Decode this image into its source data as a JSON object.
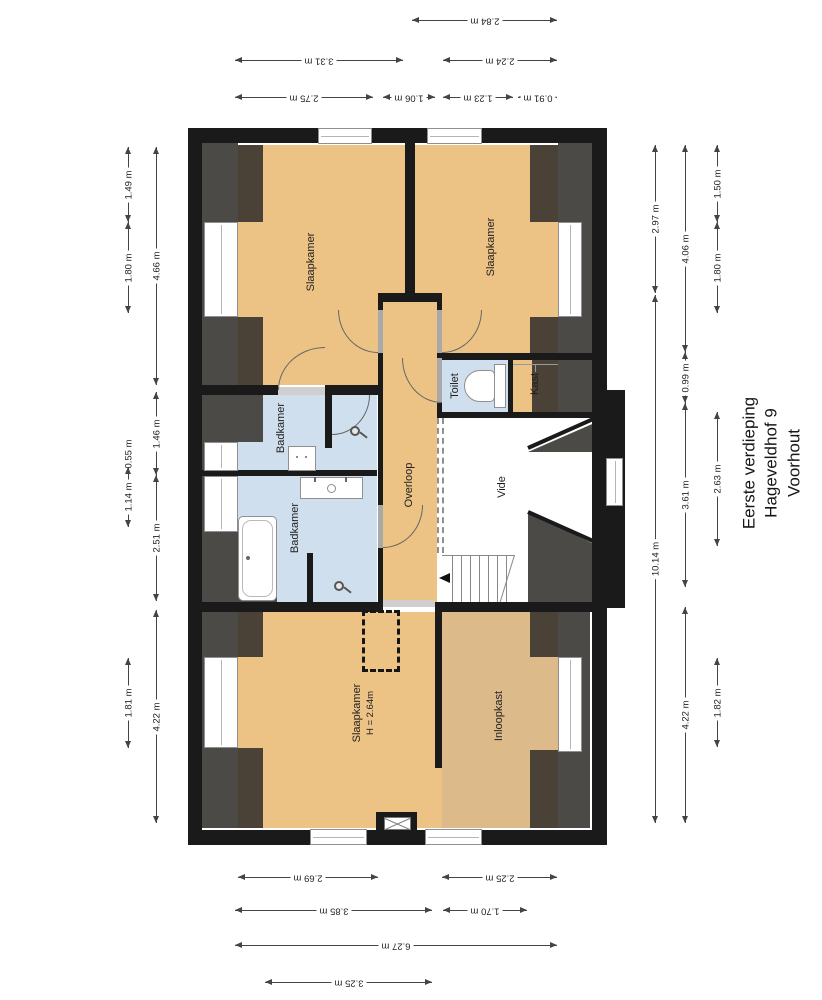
{
  "title": {
    "lines": [
      "Eerste verdieping",
      "Hageveldhof 9",
      "Voorhout"
    ]
  },
  "rooms": [
    {
      "name": "slaapkamer-top-left",
      "label": "Slaapkamer",
      "x": 312,
      "y": 262
    },
    {
      "name": "slaapkamer-top-right",
      "label": "Slaapkamer",
      "x": 492,
      "y": 247
    },
    {
      "name": "badkamer-small",
      "label": "Badkamer",
      "x": 282,
      "y": 428
    },
    {
      "name": "badkamer-large",
      "label": "Badkamer",
      "x": 296,
      "y": 528
    },
    {
      "name": "overloop",
      "label": "Overloop",
      "x": 410,
      "y": 485
    },
    {
      "name": "toilet",
      "label": "Toilet",
      "x": 456,
      "y": 386
    },
    {
      "name": "kast",
      "label": "Kast",
      "x": 536,
      "y": 384
    },
    {
      "name": "vide",
      "label": "Vide",
      "x": 503,
      "y": 487
    },
    {
      "name": "slaapkamer-bottom",
      "label": "Slaapkamer",
      "sub": "H = 2.64m",
      "x": 364,
      "y": 713
    },
    {
      "name": "inloopkast",
      "label": "Inloopkast",
      "x": 500,
      "y": 716
    }
  ],
  "dimensions": {
    "top": [
      {
        "label": "2.84 m",
        "from": 412,
        "to": 557,
        "at": 20
      },
      {
        "label": "3.31 m",
        "from": 235,
        "to": 403,
        "at": 60
      },
      {
        "label": "2.24 m",
        "from": 443,
        "to": 557,
        "at": 60
      },
      {
        "label": "2.75 m",
        "from": 235,
        "to": 373,
        "at": 97
      },
      {
        "label": "1.06 m",
        "from": 383,
        "to": 435,
        "at": 97
      },
      {
        "label": "1.23 m",
        "from": 443,
        "to": 513,
        "at": 97
      },
      {
        "label": "0.91 m",
        "from": 518,
        "to": 557,
        "at": 97
      }
    ],
    "bottom": [
      {
        "label": "2.69 m",
        "from": 238,
        "to": 378,
        "at": 877
      },
      {
        "label": "2.25 m",
        "from": 442,
        "to": 557,
        "at": 877
      },
      {
        "label": "3.85 m",
        "from": 235,
        "to": 432,
        "at": 910
      },
      {
        "label": "1.70 m",
        "from": 443,
        "to": 527,
        "at": 910
      },
      {
        "label": "6.27 m",
        "from": 235,
        "to": 557,
        "at": 945
      },
      {
        "label": "3.25 m",
        "from": 265,
        "to": 432,
        "at": 982
      }
    ],
    "left": [
      {
        "label": "1.49 m",
        "from": 147,
        "to": 222,
        "at": 128
      },
      {
        "label": "1.80 m",
        "from": 222,
        "to": 313,
        "at": 128
      },
      {
        "label": "0.55 m",
        "from": 440,
        "to": 467,
        "at": 128
      },
      {
        "label": "1.14 m",
        "from": 467,
        "to": 527,
        "at": 128
      },
      {
        "label": "1.81 m",
        "from": 658,
        "to": 748,
        "at": 128
      },
      {
        "label": "4.66 m",
        "from": 147,
        "to": 385,
        "at": 156
      },
      {
        "label": "1.46 m",
        "from": 392,
        "to": 475,
        "at": 156
      },
      {
        "label": "2.51 m",
        "from": 475,
        "to": 601,
        "at": 156
      },
      {
        "label": "4.22 m",
        "from": 610,
        "to": 823,
        "at": 156
      }
    ],
    "right": [
      {
        "label": "2.97 m",
        "from": 145,
        "to": 293,
        "at": 655
      },
      {
        "label": "10.14 m",
        "from": 295,
        "to": 823,
        "at": 655
      },
      {
        "label": "4.06 m",
        "from": 145,
        "to": 352,
        "at": 685
      },
      {
        "label": "0.99 m",
        "from": 352,
        "to": 403,
        "at": 685
      },
      {
        "label": "3.61 m",
        "from": 403,
        "to": 587,
        "at": 685
      },
      {
        "label": "4.22 m",
        "from": 607,
        "to": 823,
        "at": 685
      },
      {
        "label": "1.50 m",
        "from": 145,
        "to": 222,
        "at": 717
      },
      {
        "label": "1.80 m",
        "from": 222,
        "to": 313,
        "at": 717
      },
      {
        "label": "2.63 m",
        "from": 412,
        "to": 546,
        "at": 717
      },
      {
        "label": "1.82 m",
        "from": 658,
        "to": 747,
        "at": 717
      }
    ]
  },
  "colors": {
    "wall": "#1a1a1a",
    "roof": "#4b4a47",
    "overlay": "#4a4137",
    "floor": "#ecc285",
    "floor_muted": "#ddba89",
    "water": "#cfdfed",
    "open": "#ffffff",
    "dim_line": "#444444",
    "label": "#1f1f1f"
  }
}
